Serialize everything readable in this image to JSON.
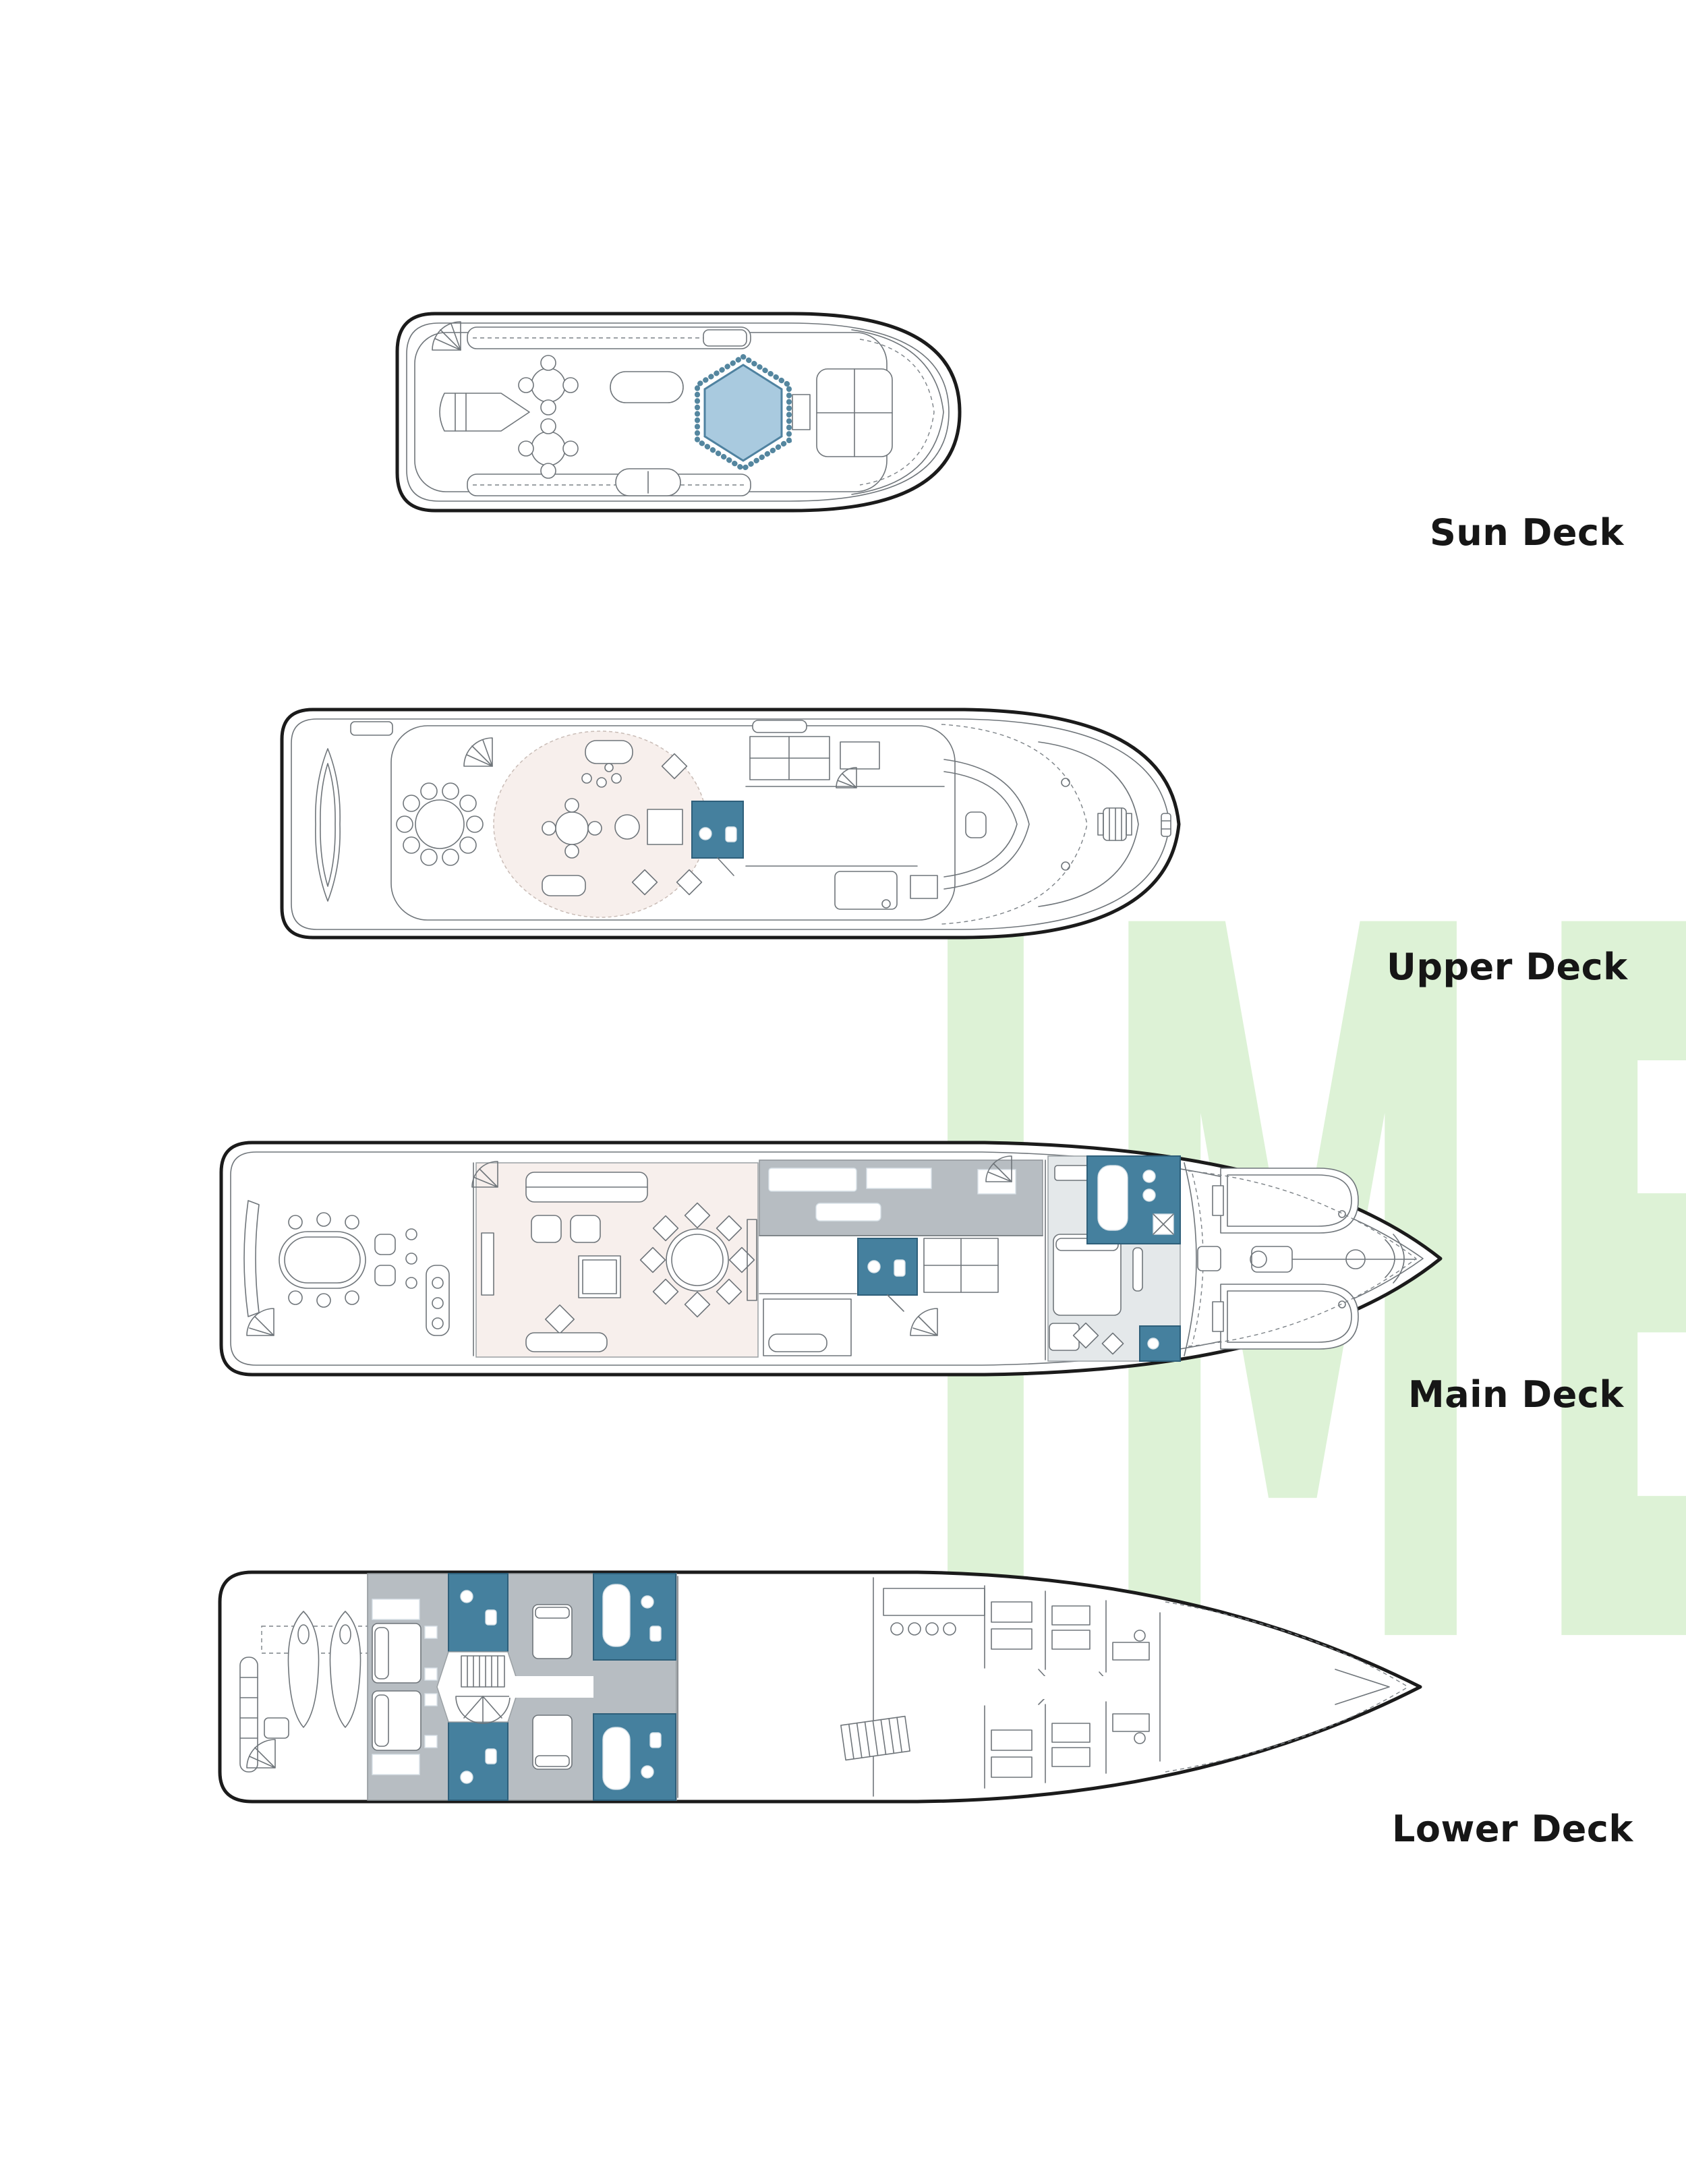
{
  "watermark": {
    "text": "IME"
  },
  "decks": [
    {
      "id": "sun-deck",
      "label": "Sun Deck"
    },
    {
      "id": "upper-deck",
      "label": "Upper Deck"
    },
    {
      "id": "main-deck",
      "label": "Main Deck"
    },
    {
      "id": "lower-deck",
      "label": "Lower Deck"
    }
  ],
  "colors": {
    "hull_line": "#1b1b1b",
    "detail_line": "#6f757a",
    "salon_pink": "#f7efec",
    "bathroom_blue": "#45809e",
    "jacuzzi_fill": "#a9cadf",
    "jacuzzi_rim": "#54869f",
    "cabin_gray": "#b7bdc2",
    "suite_gray": "#e4e8ea",
    "watermark_green": "#ddf2d6",
    "label_color": "#161616"
  }
}
